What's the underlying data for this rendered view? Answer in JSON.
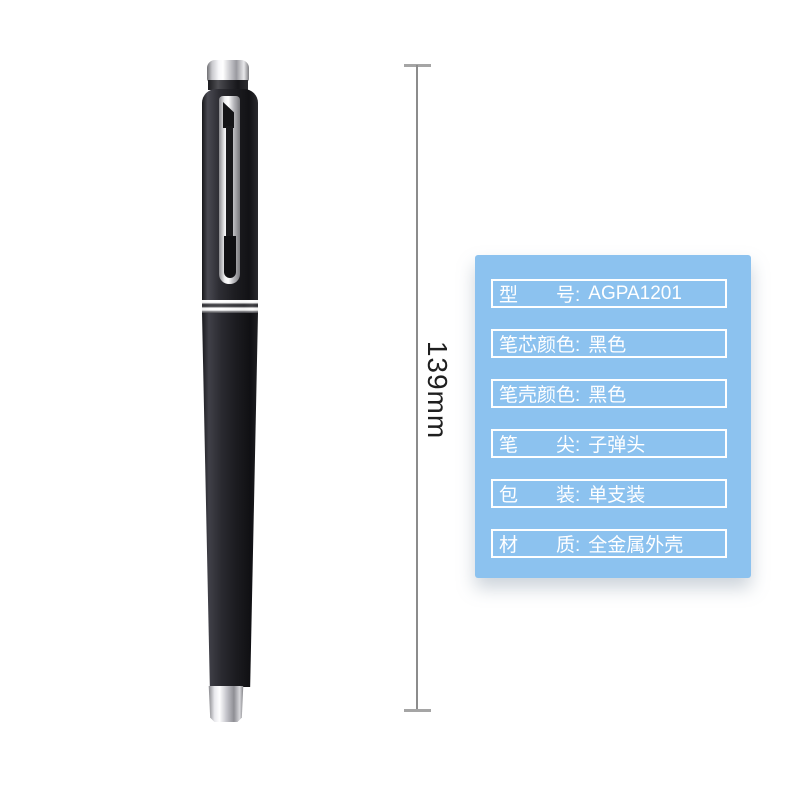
{
  "page": {
    "background": "#ffffff"
  },
  "pen": {
    "description": "black metal pen with chrome cap top, clip, center ring and tip",
    "cap_color": "#232327",
    "body_color": "#1e1e22",
    "trim_color": "#d9d9dd"
  },
  "dimension": {
    "label": "139mm",
    "line_color": "#8c8c8c",
    "text_color": "#1f1f1f"
  },
  "spec_box": {
    "background": "#8cc2ef",
    "border_color": "#ffffff",
    "text_color": "#ffffff",
    "rows": [
      {
        "label": "型　　号:",
        "value": "AGPA1201"
      },
      {
        "label": "笔芯颜色:",
        "value": "黑色"
      },
      {
        "label": "笔壳颜色:",
        "value": "黑色"
      },
      {
        "label": "笔　　尖:",
        "value": "子弹头"
      },
      {
        "label": "包　　装:",
        "value": "单支装"
      },
      {
        "label": "材　　质:",
        "value": "全金属外壳"
      }
    ]
  }
}
